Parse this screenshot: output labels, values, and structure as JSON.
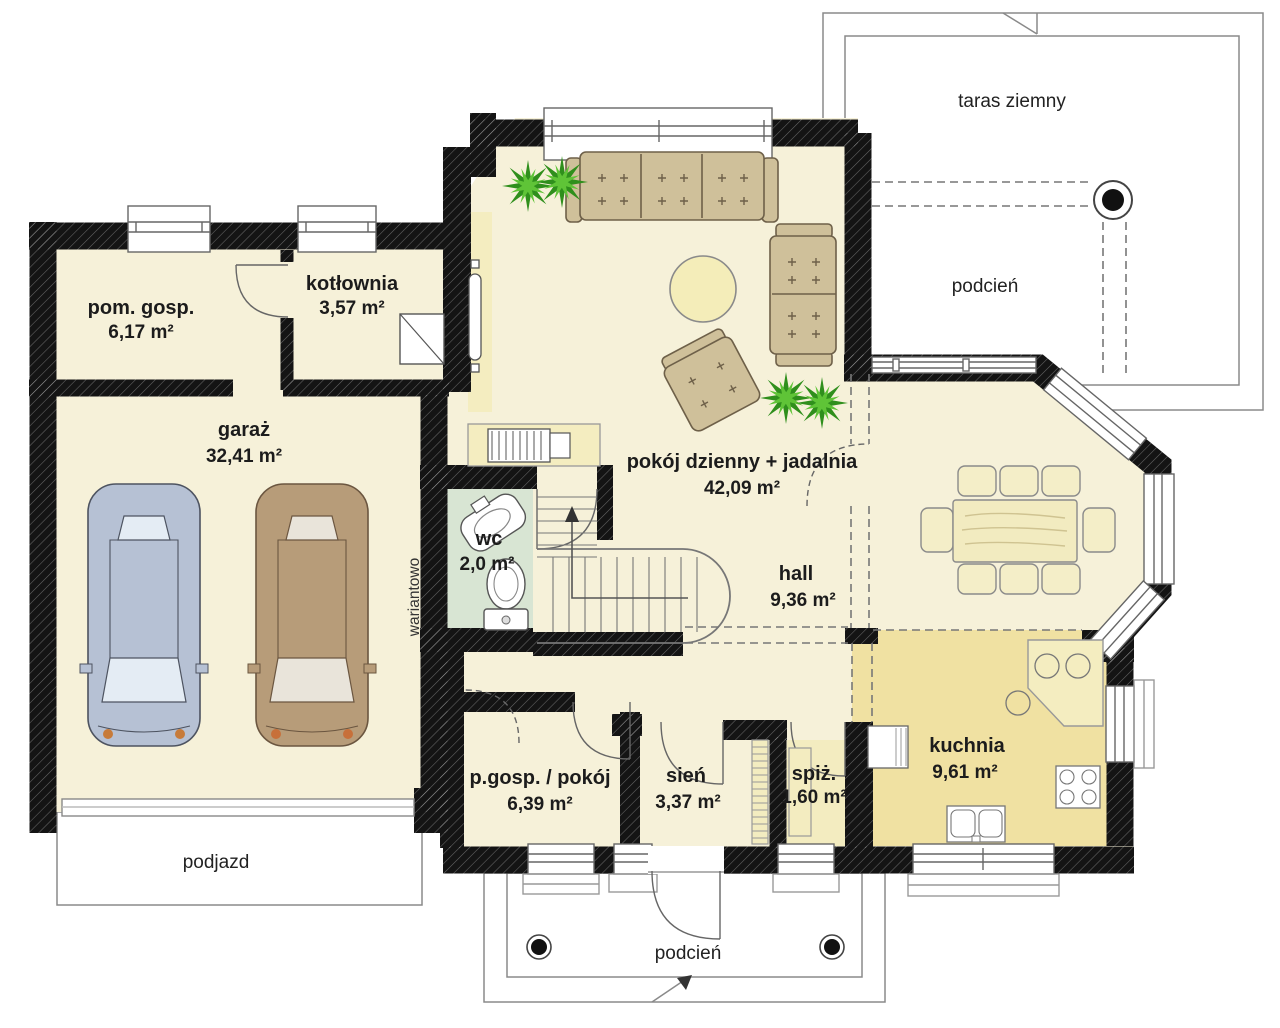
{
  "plan": {
    "title": "rzut parteru (floor plan)",
    "rooms": [
      {
        "name": "pom. gosp.",
        "area": "6,17 m²"
      },
      {
        "name": "kotłownia",
        "area": "3,57 m²"
      },
      {
        "name": "garaż",
        "area": "32,41 m²"
      },
      {
        "name": "pokój dzienny + jadalnia",
        "area": "42,09 m²"
      },
      {
        "name": "wc",
        "area": "2,0 m²"
      },
      {
        "name": "hall",
        "area": "9,36 m²"
      },
      {
        "name": "p.gosp. / pokój",
        "area": "6,39 m²"
      },
      {
        "name": "sień",
        "area": "3,37 m²"
      },
      {
        "name": "spiż.",
        "area": "1,60 m²"
      },
      {
        "name": "kuchnia",
        "area": "9,61 m²"
      }
    ],
    "outdoor": {
      "taras": "taras ziemny",
      "podcien_right": "podcień",
      "podcien_bottom": "podcień",
      "podjazd": "podjazd"
    },
    "annotations": {
      "variant": "wariantowo"
    },
    "colors": {
      "wall": "#141414",
      "floor": "#f6f1d9",
      "kitchen_floor": "#f0e1a2",
      "wc_floor": "#d8e5d3",
      "accent": "#f4edc0",
      "outline": "#8a8a8a"
    }
  }
}
